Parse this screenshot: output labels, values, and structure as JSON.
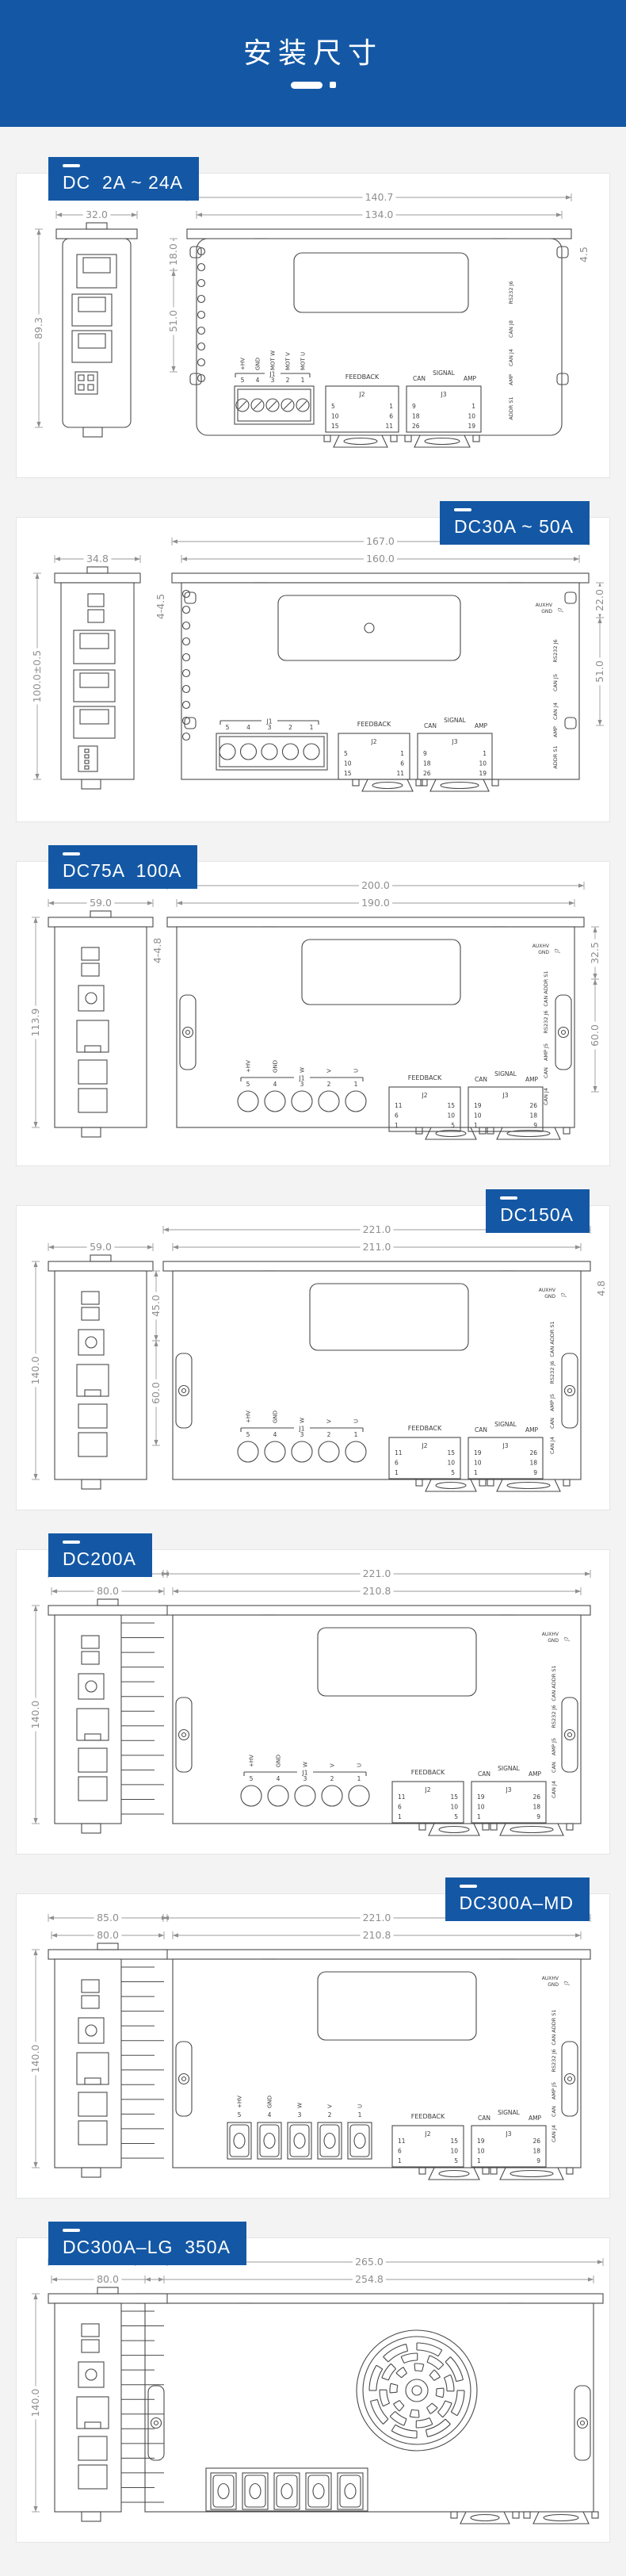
{
  "header": {
    "title": "安装尺寸"
  },
  "colors": {
    "accent": "#1458a5",
    "line": "#4a4a4a",
    "dim": "#8f8f8f",
    "page_bg": "#f3f3f4",
    "card_bg": "#ffffff"
  },
  "sections": [
    {
      "id": "dc2-24",
      "label": "DC  2A ~ 24A",
      "label_side": "left",
      "type": "small-rounded",
      "dims": {
        "side_widths": [
          "32.0"
        ],
        "side_height": "89.3",
        "front_widths": [
          "140.7",
          "134.0"
        ],
        "left": [
          "18.0",
          "51.0"
        ],
        "right": [
          "4.5"
        ]
      },
      "terminal": {
        "style": "screws",
        "name": "J1",
        "labels": [
          "+HV",
          "GND",
          "MOT W",
          "MOT V",
          "MOT U"
        ],
        "numbers": [
          "5",
          "4",
          "3",
          "2",
          "1"
        ]
      },
      "tables": {
        "feedback": {
          "title": "FEEDBACK",
          "name": "J2",
          "left": [
            "5",
            "10",
            "15"
          ],
          "right": [
            "1",
            "6",
            "11"
          ]
        },
        "signal": {
          "titles": [
            "CAN",
            "SIGNAL",
            "AMP"
          ],
          "name": "J3",
          "left": [
            "9",
            "18",
            "26"
          ],
          "right": [
            "1",
            "10",
            "19"
          ]
        }
      },
      "right_labels": [
        "RS232 J6",
        "CAN J8",
        "CAN J4",
        "AMP",
        "ADDR S1"
      ]
    },
    {
      "id": "dc30-50",
      "label": "DC30A ~ 50A",
      "label_side": "right",
      "type": "small-square",
      "dims": {
        "side_widths": [
          "34.8"
        ],
        "side_height": "100.0±0.5",
        "front_widths": [
          "167.0",
          "160.0"
        ],
        "left": [
          "4-4.5"
        ],
        "right": [
          "22.0",
          "51.0"
        ]
      },
      "terminal": {
        "style": "open-screws",
        "name": "J1",
        "labels": [],
        "numbers": [
          "5",
          "4",
          "3",
          "2",
          "1"
        ]
      },
      "tables": {
        "feedback": {
          "title": "FEEDBACK",
          "name": "J2",
          "left": [
            "5",
            "10",
            "15"
          ],
          "right": [
            "1",
            "6",
            "11"
          ]
        },
        "signal": {
          "titles": [
            "CAN",
            "SIGNAL",
            "AMP"
          ],
          "name": "J3",
          "left": [
            "9",
            "18",
            "26"
          ],
          "right": [
            "1",
            "10",
            "19"
          ]
        }
      },
      "aux_label": {
        "lines": [
          "AUXHV",
          "GND"
        ],
        "name": "J7"
      },
      "right_labels": [
        "RS232 J6",
        "CAN J5",
        "CAN J4",
        "AMP",
        "ADDR S1"
      ]
    },
    {
      "id": "dc75-100",
      "label": "DC75A  100A",
      "label_side": "left",
      "type": "mid",
      "dims": {
        "side_widths": [
          "59.0"
        ],
        "side_height": "113.9",
        "front_widths": [
          "200.0",
          "190.0"
        ],
        "left": [
          "4-4.8"
        ],
        "right": [
          "32.5",
          "60.0"
        ]
      },
      "terminal": {
        "style": "circles",
        "name": "J1",
        "labels": [
          "+HV",
          "GND",
          "W",
          "V",
          "U"
        ],
        "numbers": [
          "5",
          "4",
          "3",
          "2",
          "1"
        ]
      },
      "tables": {
        "feedback": {
          "title": "FEEDBACK",
          "name": "J2",
          "left": [
            "11",
            "6",
            "1"
          ],
          "right": [
            "15",
            "10",
            "5"
          ]
        },
        "signal": {
          "titles": [
            "CAN",
            "SIGNAL",
            "AMP"
          ],
          "name": "J3",
          "left": [
            "19",
            "10",
            "1"
          ],
          "right": [
            "26",
            "18",
            "9"
          ]
        }
      },
      "aux_label": {
        "lines": [
          "AUXHV",
          "GND"
        ],
        "name": "J7"
      },
      "right_labels": [
        "CAN ADDR S1",
        "RS232 J6",
        "AMP J5",
        "CAN",
        "CAN J4"
      ]
    },
    {
      "id": "dc150",
      "label": "DC150A",
      "label_side": "right",
      "type": "mid-tall",
      "dims": {
        "side_widths": [
          "59.0"
        ],
        "side_height": "140.0",
        "front_widths": [
          "221.0",
          "211.0"
        ],
        "left": [
          "45.0",
          "60.0"
        ],
        "right": [
          "4.8"
        ]
      },
      "terminal": {
        "style": "circles",
        "name": "J1",
        "labels": [
          "+HV",
          "GND",
          "W",
          "V",
          "U"
        ],
        "numbers": [
          "5",
          "4",
          "3",
          "2",
          "1"
        ]
      },
      "tables": {
        "feedback": {
          "title": "FEEDBACK",
          "name": "J2",
          "left": [
            "11",
            "6",
            "1"
          ],
          "right": [
            "15",
            "10",
            "5"
          ]
        },
        "signal": {
          "titles": [
            "CAN",
            "SIGNAL",
            "AMP"
          ],
          "name": "J3",
          "left": [
            "19",
            "10",
            "1"
          ],
          "right": [
            "26",
            "18",
            "9"
          ]
        }
      },
      "aux_label": {
        "lines": [
          "AUXHV",
          "GND"
        ],
        "name": "J7"
      },
      "right_labels": [
        "CAN ADDR S1",
        "RS232 J6",
        "AMP J5",
        "CAN",
        "CAN J4"
      ]
    },
    {
      "id": "dc200",
      "label": "DC200A",
      "label_side": "left",
      "type": "large",
      "dims": {
        "side_widths": [
          "85.0",
          "80.0"
        ],
        "side_height": "140.0",
        "front_widths": [
          "221.0",
          "210.8"
        ],
        "left": [],
        "right": []
      },
      "terminal": {
        "style": "circles",
        "name": "J1",
        "labels": [
          "+HV",
          "GND",
          "W",
          "V",
          "U"
        ],
        "numbers": [
          "5",
          "4",
          "3",
          "2",
          "1"
        ]
      },
      "tables": {
        "feedback": {
          "title": "FEEDBACK",
          "name": "J2",
          "left": [
            "11",
            "6",
            "1"
          ],
          "right": [
            "15",
            "10",
            "5"
          ]
        },
        "signal": {
          "titles": [
            "CAN",
            "SIGNAL",
            "AMP"
          ],
          "name": "J3",
          "left": [
            "19",
            "10",
            "1"
          ],
          "right": [
            "26",
            "18",
            "9"
          ]
        }
      },
      "aux_label": {
        "lines": [
          "AUXHV",
          "GND"
        ],
        "name": "J7"
      },
      "right_labels": [
        "CAN ADDR S1",
        "RS232 J6",
        "AMP J5",
        "CAN",
        "CAN J4"
      ]
    },
    {
      "id": "dc300-md",
      "label": "DC300A–MD",
      "label_side": "right",
      "type": "large-blocks",
      "dims": {
        "side_widths": [
          "85.0",
          "80.0"
        ],
        "side_height": "140.0",
        "front_widths": [
          "221.0",
          "210.8"
        ],
        "left": [],
        "right": []
      },
      "terminal": {
        "style": "blocks",
        "name": "J1",
        "labels": [
          "+HV",
          "GND",
          "W",
          "V",
          "U"
        ],
        "numbers": [
          "5",
          "4",
          "3",
          "2",
          "1"
        ]
      },
      "tables": {
        "feedback": {
          "title": "FEEDBACK",
          "name": "J2",
          "left": [
            "11",
            "6",
            "1"
          ],
          "right": [
            "15",
            "10",
            "5"
          ]
        },
        "signal": {
          "titles": [
            "CAN",
            "SIGNAL",
            "AMP"
          ],
          "name": "J3",
          "left": [
            "19",
            "10",
            "1"
          ],
          "right": [
            "26",
            "18",
            "9"
          ]
        }
      },
      "aux_label": {
        "lines": [
          "AUXHV",
          "GND"
        ],
        "name": "J7"
      },
      "right_labels": [
        "CAN ADDR S1",
        "RS232 J6",
        "AMP J5",
        "CAN",
        "CAN J4"
      ]
    },
    {
      "id": "dc300-lg",
      "label": "DC300A–LG  350A",
      "label_side": "left",
      "type": "xl-fan",
      "dims": {
        "side_widths": [
          "85.0",
          "80.0"
        ],
        "side_height": "140.0",
        "front_widths": [
          "265.0",
          "254.8"
        ],
        "left": [],
        "right": []
      },
      "terminal": {
        "style": "blocks",
        "name": "",
        "labels": [],
        "numbers": []
      },
      "tables": null,
      "aux_label": null,
      "right_labels": []
    }
  ]
}
